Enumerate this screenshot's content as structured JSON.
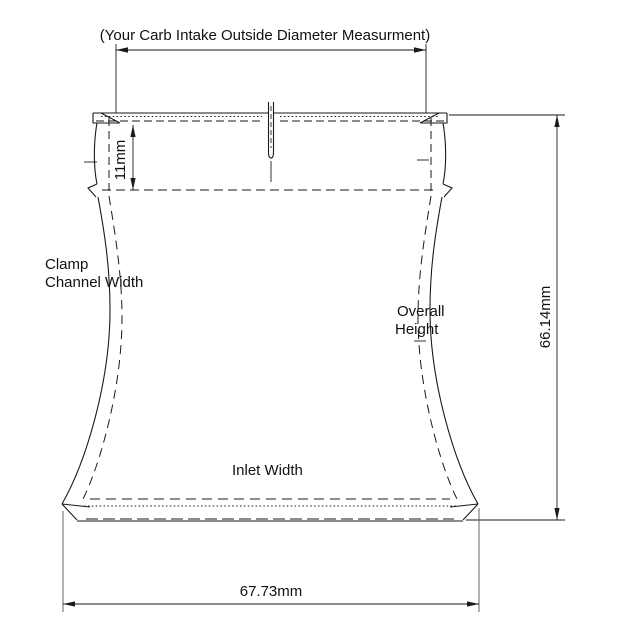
{
  "annotations": {
    "carb_od_note": "(Your Carb Intake Outside Diameter Measurment)",
    "clamp_channel_line1": "Clamp",
    "clamp_channel_line2": "Channel Width",
    "overall_height_line1": "Overall",
    "overall_height_line2": "Height",
    "inlet_width_label": "Inlet Width"
  },
  "dimensions": {
    "clamp_channel_depth": "11mm",
    "overall_height": "66.14mm",
    "inlet_width": "67.73mm"
  },
  "colors": {
    "line": "#1a1a1a",
    "background": "#ffffff",
    "text": "#111111"
  }
}
